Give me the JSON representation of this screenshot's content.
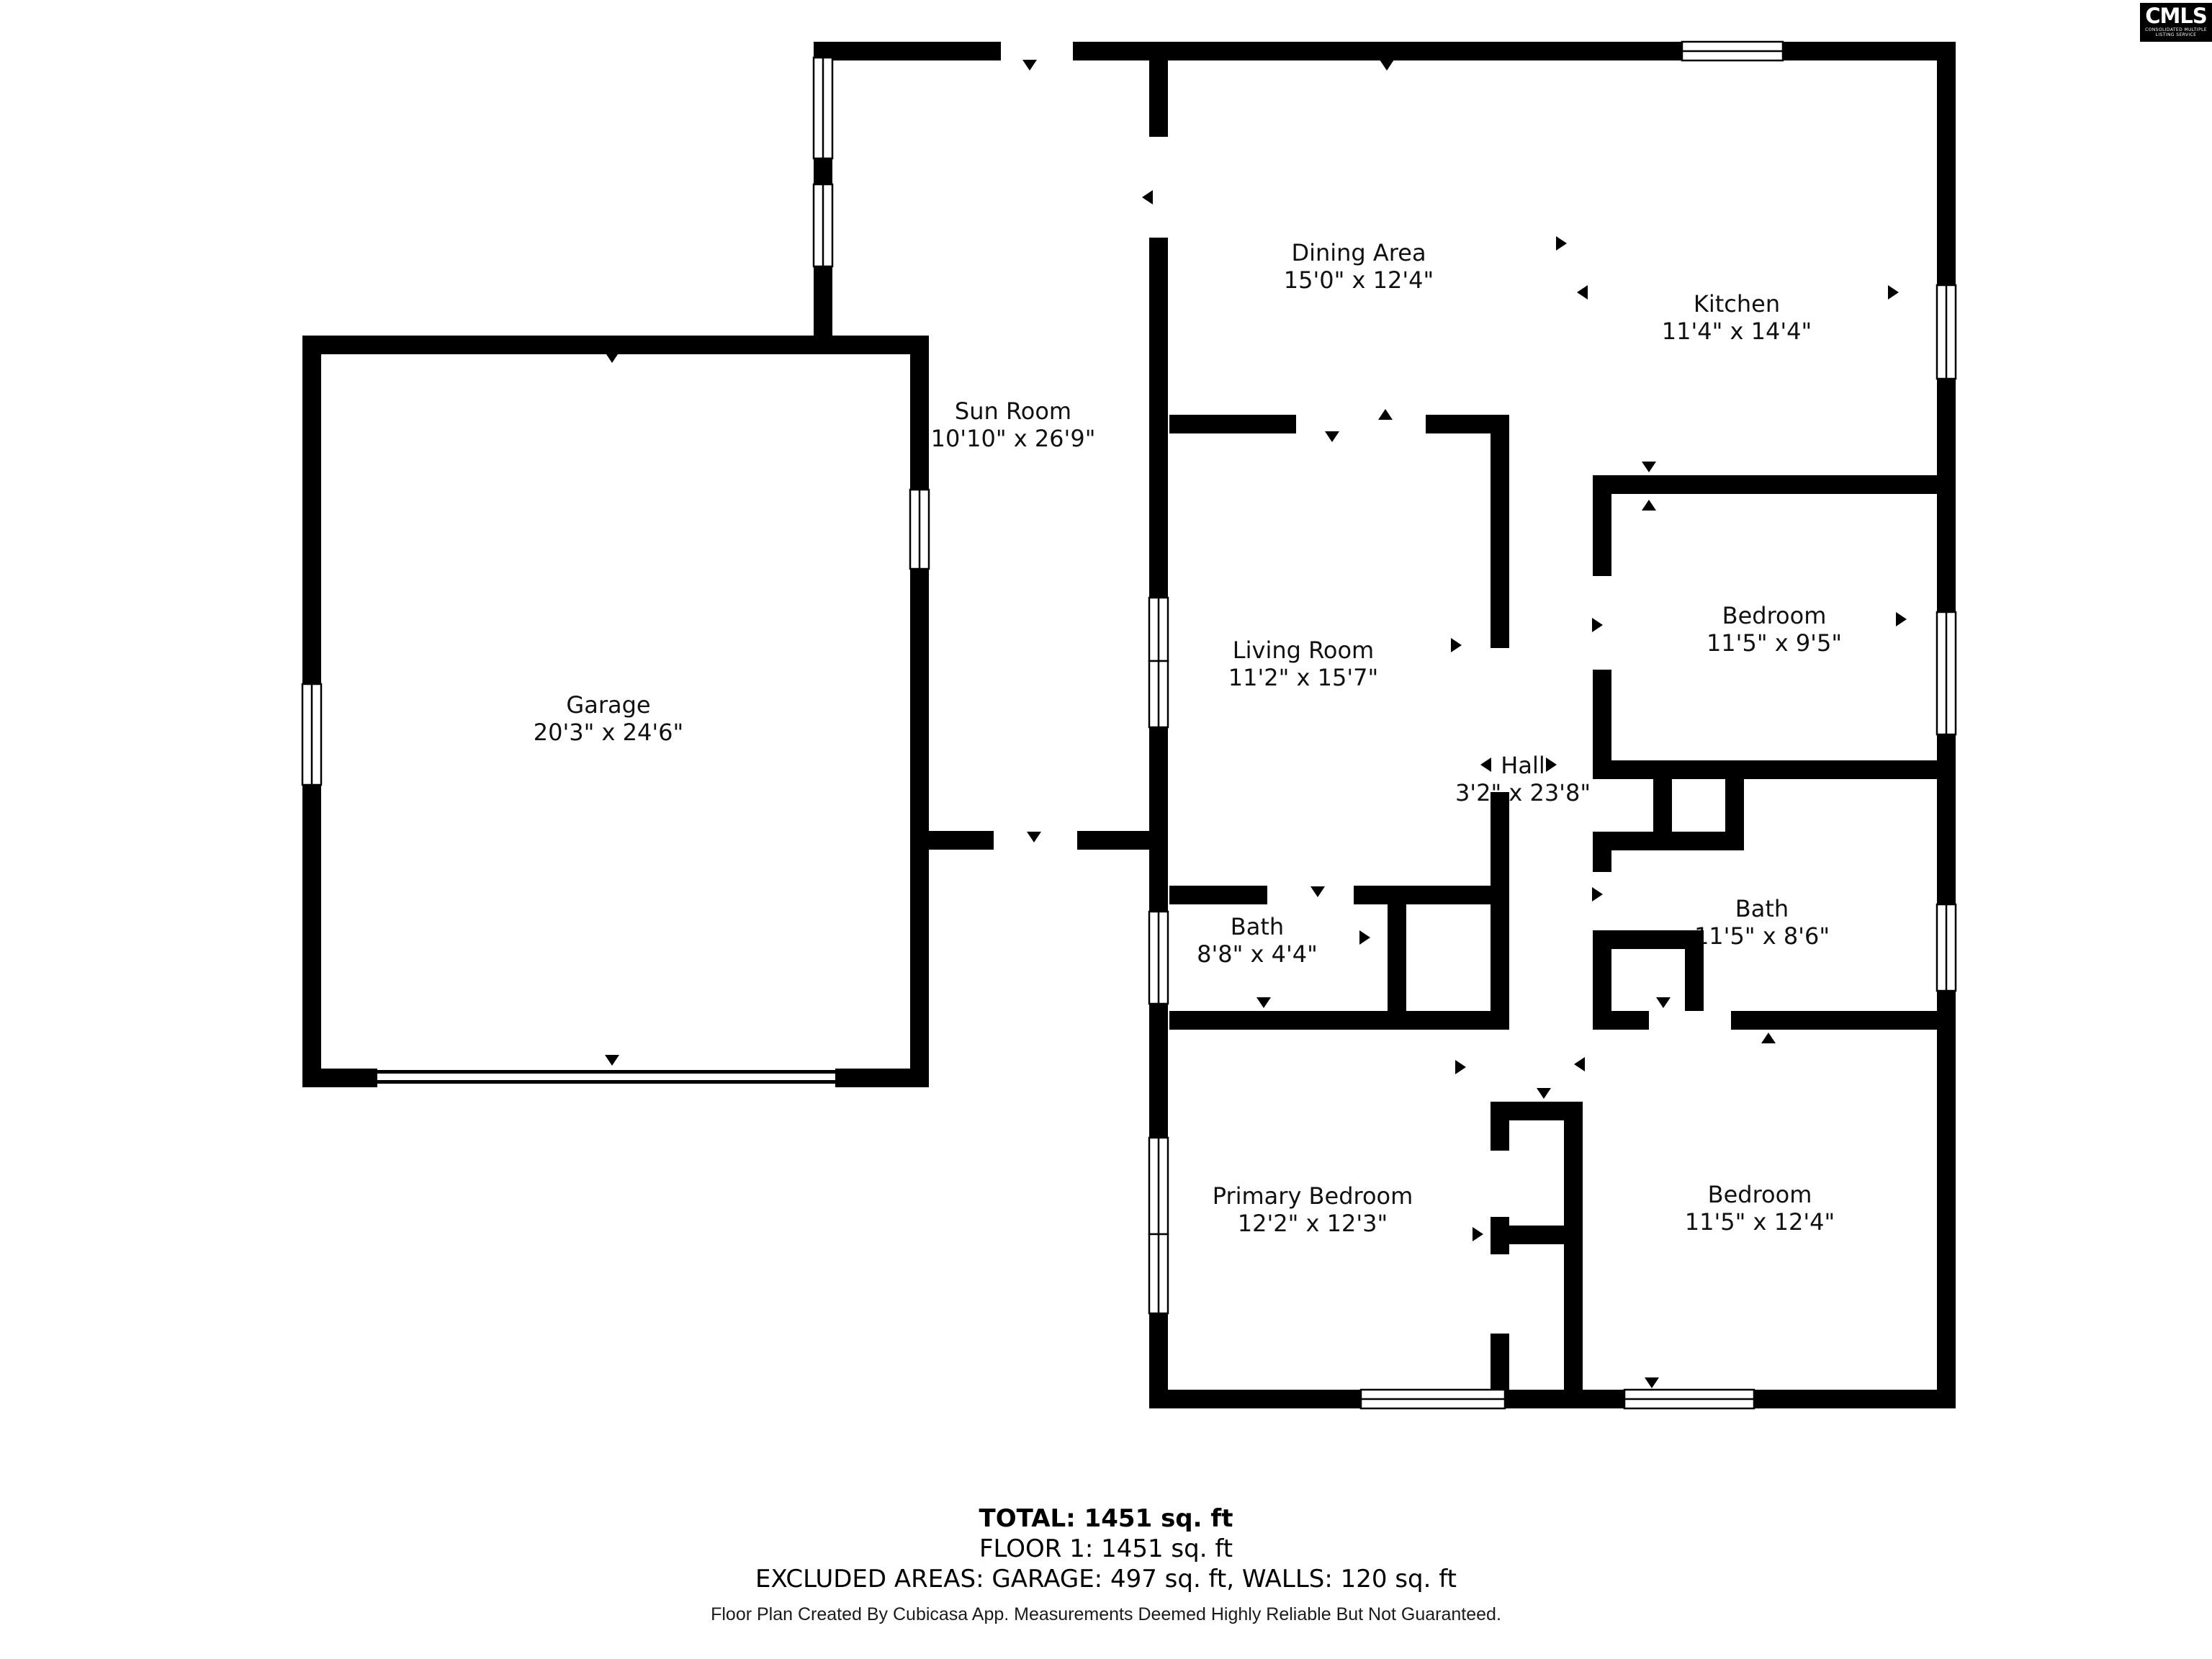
{
  "logo": {
    "text": "CMLS",
    "subtext": "CONSOLIDATED MULTIPLE LISTING SERVICE"
  },
  "rooms": [
    {
      "name": "Dining Area",
      "dims": "15'0\" x 12'4\""
    },
    {
      "name": "Kitchen",
      "dims": "11'4\" x 14'4\""
    },
    {
      "name": "Sun Room",
      "dims": "10'10\" x 26'9\""
    },
    {
      "name": "Garage",
      "dims": "20'3\" x 24'6\""
    },
    {
      "name": "Living Room",
      "dims": "11'2\" x 15'7\""
    },
    {
      "name": "Hall",
      "dims": "3'2\" x 23'8\""
    },
    {
      "name": "Bedroom",
      "dims": "11'5\" x 9'5\""
    },
    {
      "name": "Bath",
      "dims": "8'8\" x 4'4\""
    },
    {
      "name": "Bath",
      "dims": "11'5\" x 8'6\""
    },
    {
      "name": "Primary Bedroom",
      "dims": "12'2\" x 12'3\""
    },
    {
      "name": "Bedroom",
      "dims": "11'5\" x 12'4\""
    }
  ],
  "summary": {
    "total": "TOTAL: 1451 sq. ft",
    "floor": "FLOOR 1: 1451 sq. ft",
    "excluded": "EXCLUDED AREAS: GARAGE: 497 sq. ft, WALLS: 120 sq. ft"
  },
  "footer": "Floor Plan Created By Cubicasa App. Measurements Deemed Highly Reliable But Not Guaranteed.",
  "colors": {
    "wall": "#000000",
    "background": "#ffffff",
    "text": "#111111"
  }
}
